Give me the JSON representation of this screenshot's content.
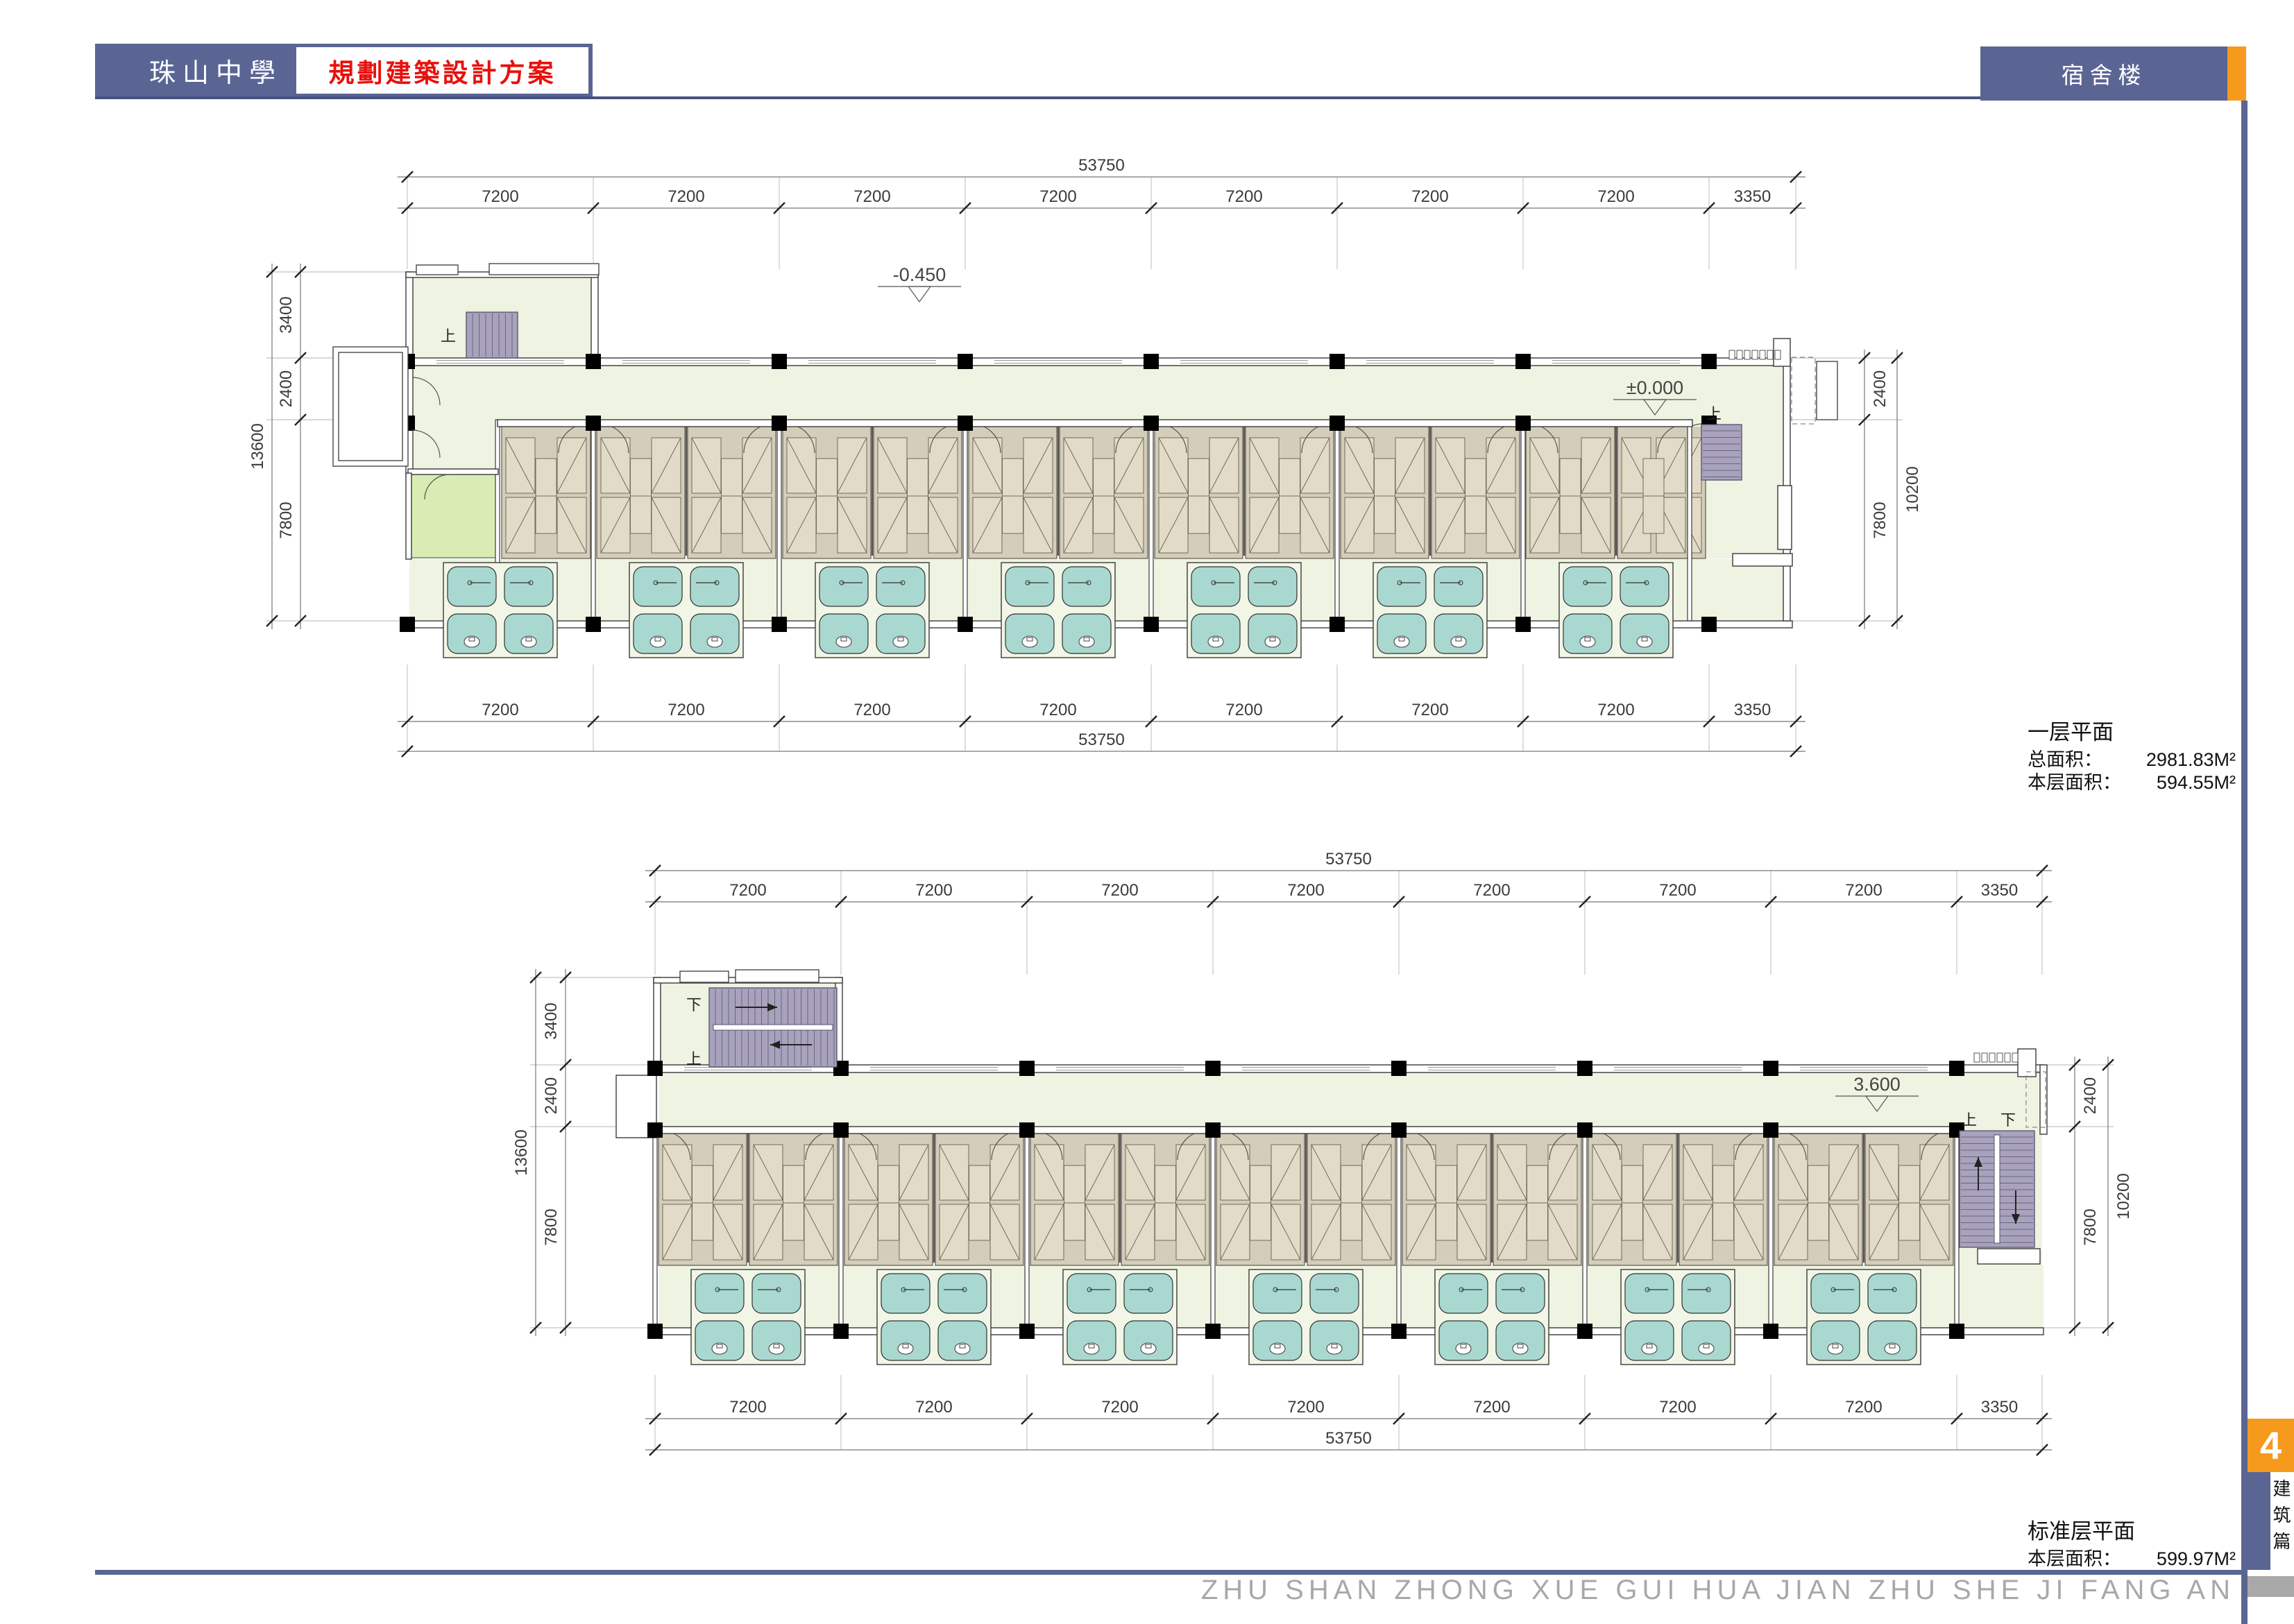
{
  "header": {
    "school_name": "珠山中學",
    "project_title": "規劃建築設計方案",
    "sheet_title": "宿舍楼"
  },
  "sidebar": {
    "page_number": "4",
    "section_label": "建筑篇"
  },
  "footer": {
    "watermark": "ZHU SHAN ZHONG XUE GUI HUA JIAN ZHU SHE JI FANG AN"
  },
  "colors": {
    "accent_blue": "#5a6594",
    "accent_orange": "#f59a1d",
    "title_red": "#e8100c",
    "floor": "#eef3e2",
    "room": "#d4cdb9",
    "bed": "#e1dbc8",
    "bath": "#a9d8d0",
    "green_room": "#d9ecb4",
    "stair": "#a8a2bd",
    "watermark_gray": "#a8a8a8"
  },
  "plans": [
    {
      "title": "一层平面",
      "area_rows": [
        {
          "label": "总面积：",
          "value": "2981.83M²"
        },
        {
          "label": "本层面积：",
          "value": "594.55M²"
        }
      ],
      "level_markers": [
        "-0.450",
        "±0.000"
      ],
      "stair_labels": [
        "上",
        "上"
      ],
      "dims": {
        "top_overall": "53750",
        "top_segments": [
          "7200",
          "7200",
          "7200",
          "7200",
          "7200",
          "7200",
          "7200",
          "3350"
        ],
        "bottom_overall": "53750",
        "bottom_segments": [
          "7200",
          "7200",
          "7200",
          "7200",
          "7200",
          "7200",
          "7200",
          "3350"
        ],
        "left_overall": "13600",
        "left_segments": [
          "3400",
          "2400",
          "7800"
        ],
        "right_overall": "10200",
        "right_segments": [
          "2400",
          "7800"
        ]
      }
    },
    {
      "title": "标准层平面",
      "area_rows": [
        {
          "label": "本层面积：",
          "value": "599.97M²"
        }
      ],
      "level_markers": [
        "3.600"
      ],
      "stair_labels": [
        "下",
        "上",
        "上",
        "下"
      ],
      "dims": {
        "top_overall": "53750",
        "top_segments": [
          "7200",
          "7200",
          "7200",
          "7200",
          "7200",
          "7200",
          "7200",
          "3350"
        ],
        "bottom_overall": "53750",
        "bottom_segments": [
          "7200",
          "7200",
          "7200",
          "7200",
          "7200",
          "7200",
          "7200",
          "3350"
        ],
        "left_overall": "13600",
        "left_segments": [
          "3400",
          "2400",
          "7800"
        ],
        "right_overall": "10200",
        "right_segments": [
          "2400",
          "7800"
        ]
      }
    }
  ]
}
